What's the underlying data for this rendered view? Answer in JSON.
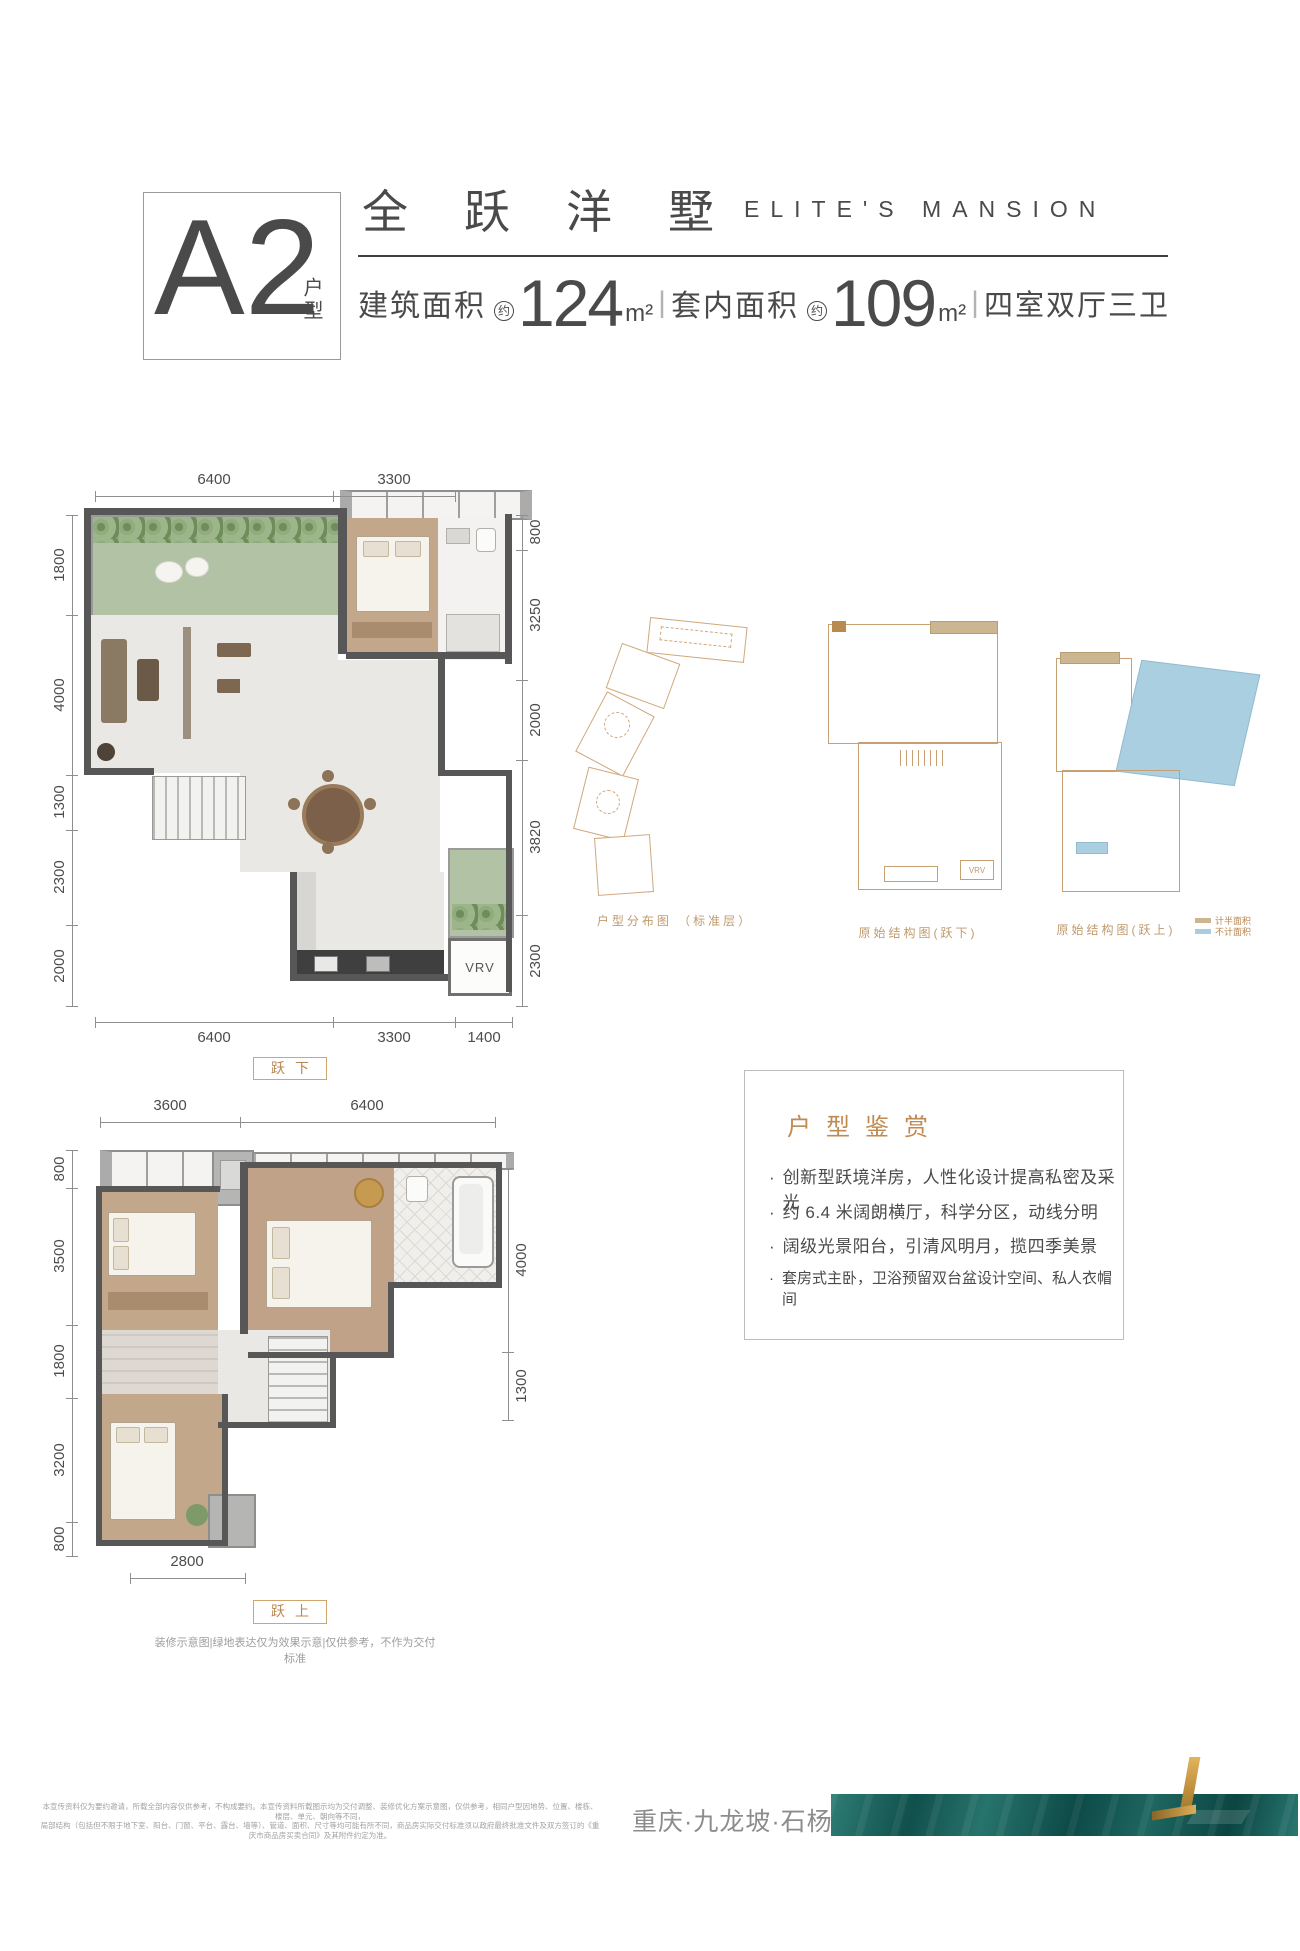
{
  "colors": {
    "accent_tan": "#bf8a50",
    "text_dark": "#4a4a4a",
    "legend_half": "#cbb691",
    "legend_excluded": "#a9cde0",
    "brand_teal": "#11504c",
    "brand_gold": "#c9993f"
  },
  "header": {
    "unit": "A2",
    "unit_label": "户型",
    "title_cn": "全跃洋墅",
    "title_en": "ELITE'S MANSION",
    "area": {
      "label1": "建筑面积",
      "approx1": "约",
      "value1": "124",
      "unit1": "m²",
      "divider1": "|",
      "label2": "套内面积",
      "approx2": "约",
      "value2": "109",
      "unit2": "m²",
      "divider2": "|",
      "rooms": "四室双厅三卫"
    }
  },
  "plan_lower": {
    "caption": "跃下",
    "vrv_label": "VRV",
    "dims_top": [
      "6400",
      "3300"
    ],
    "dims_bottom": [
      "6400",
      "3300",
      "1400"
    ],
    "dims_left": [
      "1800",
      "4000",
      "1300",
      "2300",
      "2000"
    ],
    "dims_right": [
      "800",
      "3250",
      "2000",
      "3820",
      "2300"
    ]
  },
  "plan_upper": {
    "caption": "跃上",
    "dims_top": [
      "3600",
      "6400"
    ],
    "dims_bottom": [
      "2800"
    ],
    "dims_left": [
      "800",
      "3500",
      "1800",
      "3200",
      "800"
    ],
    "dims_right": [
      "4000",
      "1300"
    ],
    "note": "装修示意图|绿地表达仅为效果示意|仅供参考，不作为交付标准"
  },
  "diagrams": {
    "captions": [
      "户型分布图 （标准层）",
      "原始结构图(跃下)",
      "原始结构图(跃上)"
    ],
    "vrv_label": "VRV",
    "legend": [
      {
        "label": "计半面积",
        "color": "#cbb691"
      },
      {
        "label": "不计面积",
        "color": "#a9cde0"
      }
    ]
  },
  "features": {
    "title": "户型鉴赏",
    "marker": "·",
    "bullets": [
      "创新型跃境洋房，人性化设计提高私密及采光",
      "约 6.4 米阔朗横厅，科学分区，动线分明",
      "阔级光景阳台，引清风明月，揽四季美景",
      "套房式主卧，卫浴预留双台盆设计空间、私人衣帽间"
    ]
  },
  "footer": {
    "disclaimer_line1": "本宣传资料仅为要约邀请，所载全部内容仅供参考，不构成要约。本宣传资料所载图示均为交付调整、装修优化方案示意图，仅供参考，相同户型因地势、位置、楼栋、楼层、单元、朝向等不同，",
    "disclaimer_line2": "局部结构（包括但不限于地下室、阳台、门窗、平台、露台、墙等）、管道、面积、尺寸等均可能有所不同，商品房实际交付标准须以政府最终批准文件及双方签订的《重庆市商品房买卖合同》及其附件约定为准。",
    "location": "重庆·九龙坡·石杨路"
  }
}
